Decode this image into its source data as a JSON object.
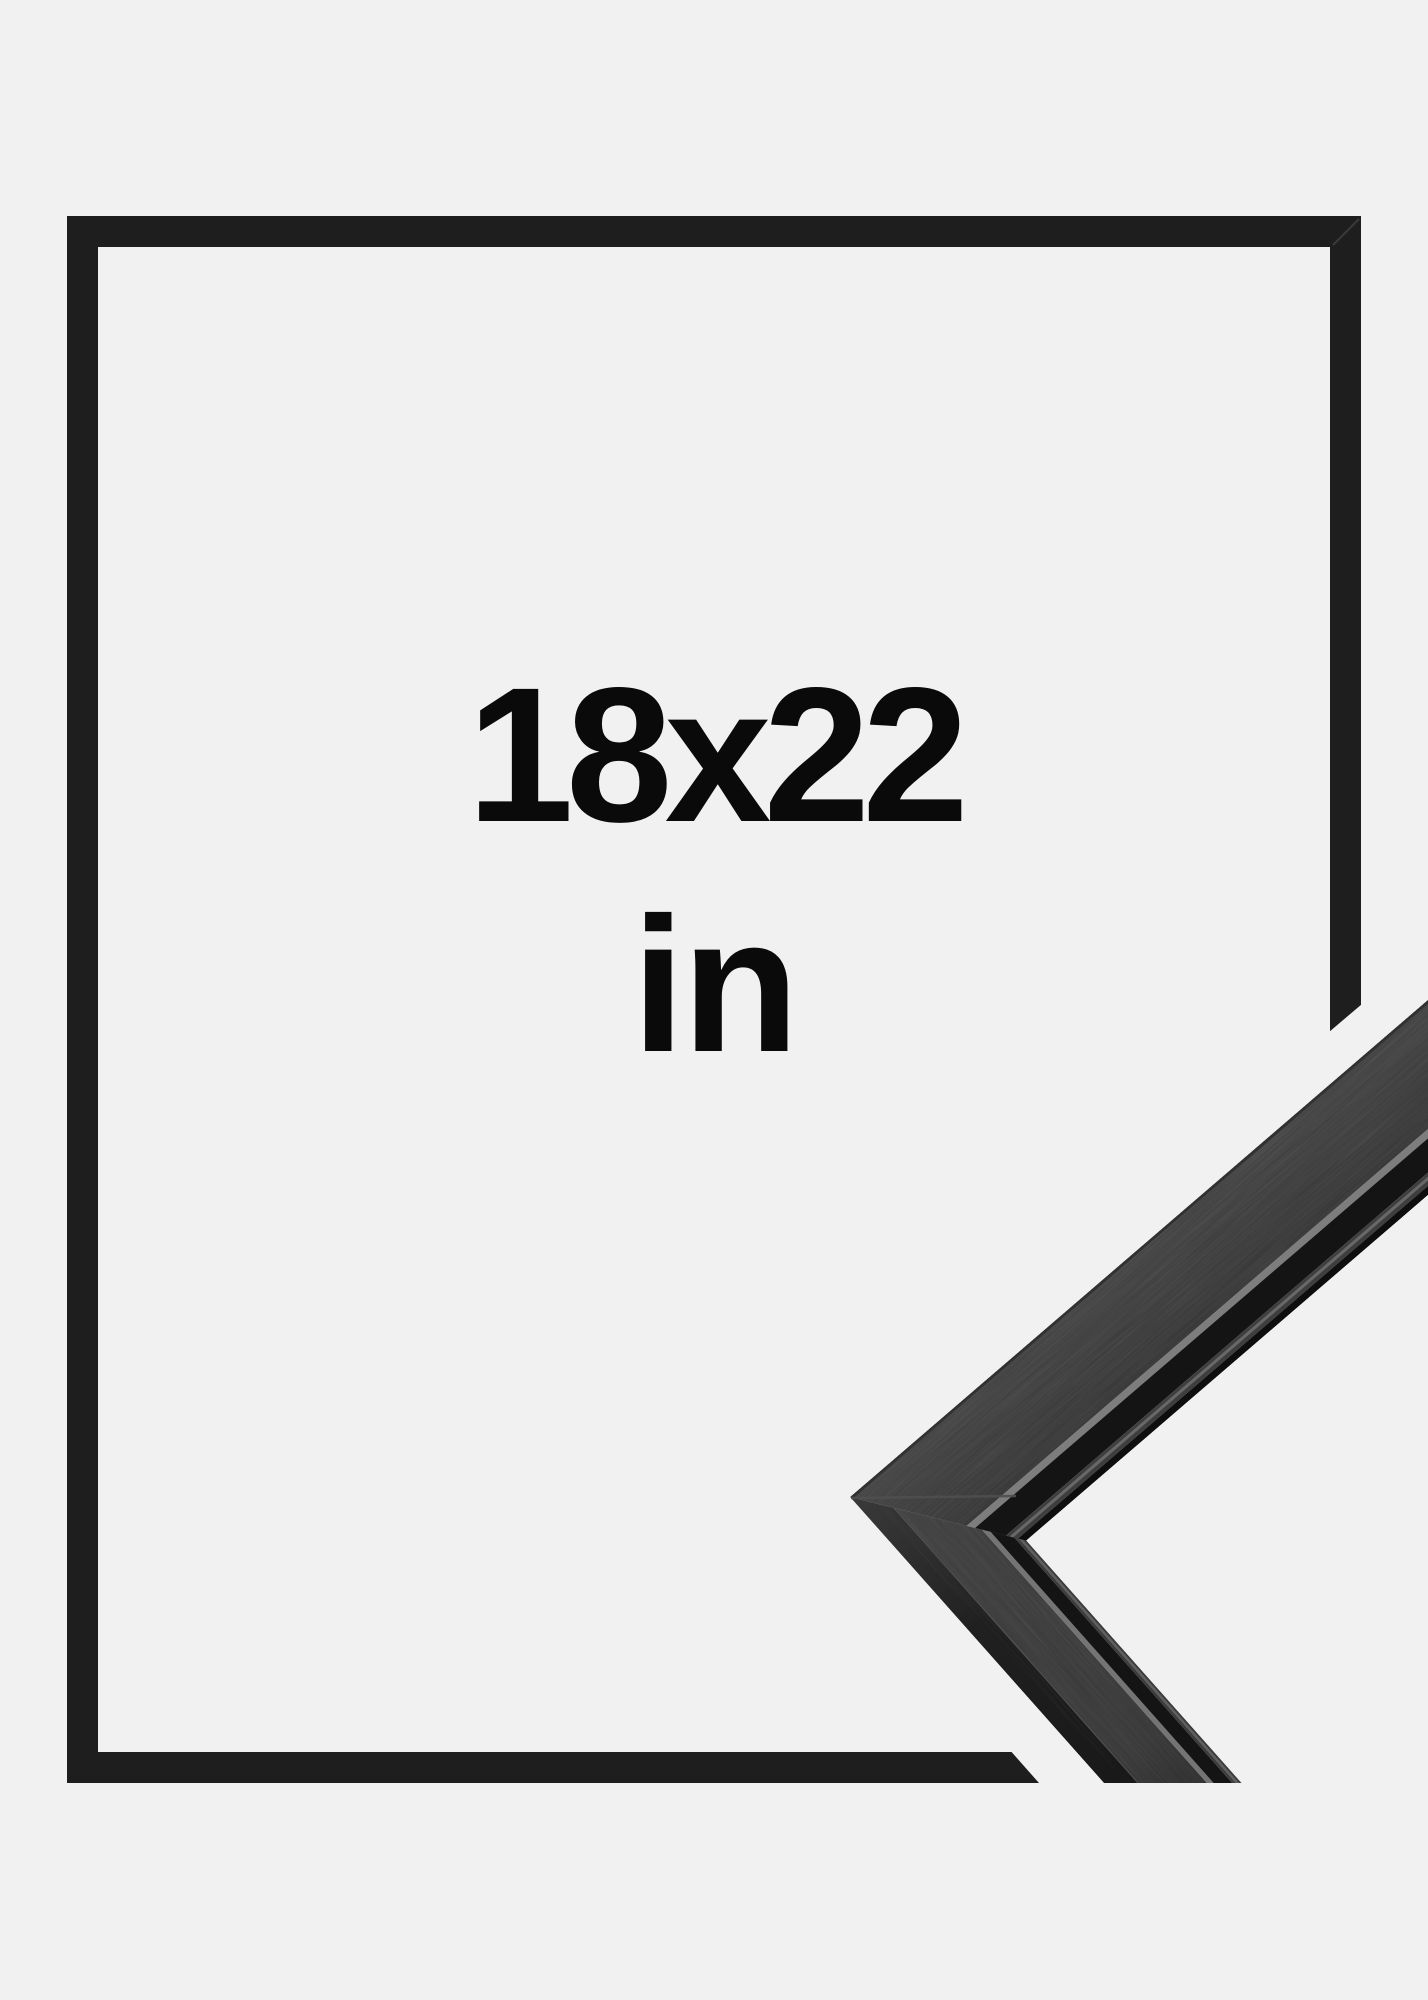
{
  "image": {
    "background_color": "#f1f1f2",
    "text_color": "#0a0a0a",
    "size_label": "18x22",
    "unit_label": "in",
    "frame_graphic": {
      "label": "thin black frame outline",
      "color": "#1e1e1e"
    },
    "corner_photo": {
      "label": "black wooden frame corner close-up",
      "face_color": "#424242",
      "lower_face_color": "#3f3f3f",
      "shadow_color": "#141414",
      "edge_highlight_color": "#7d7d7d",
      "outer_face_color": "#1c1c1c"
    }
  }
}
